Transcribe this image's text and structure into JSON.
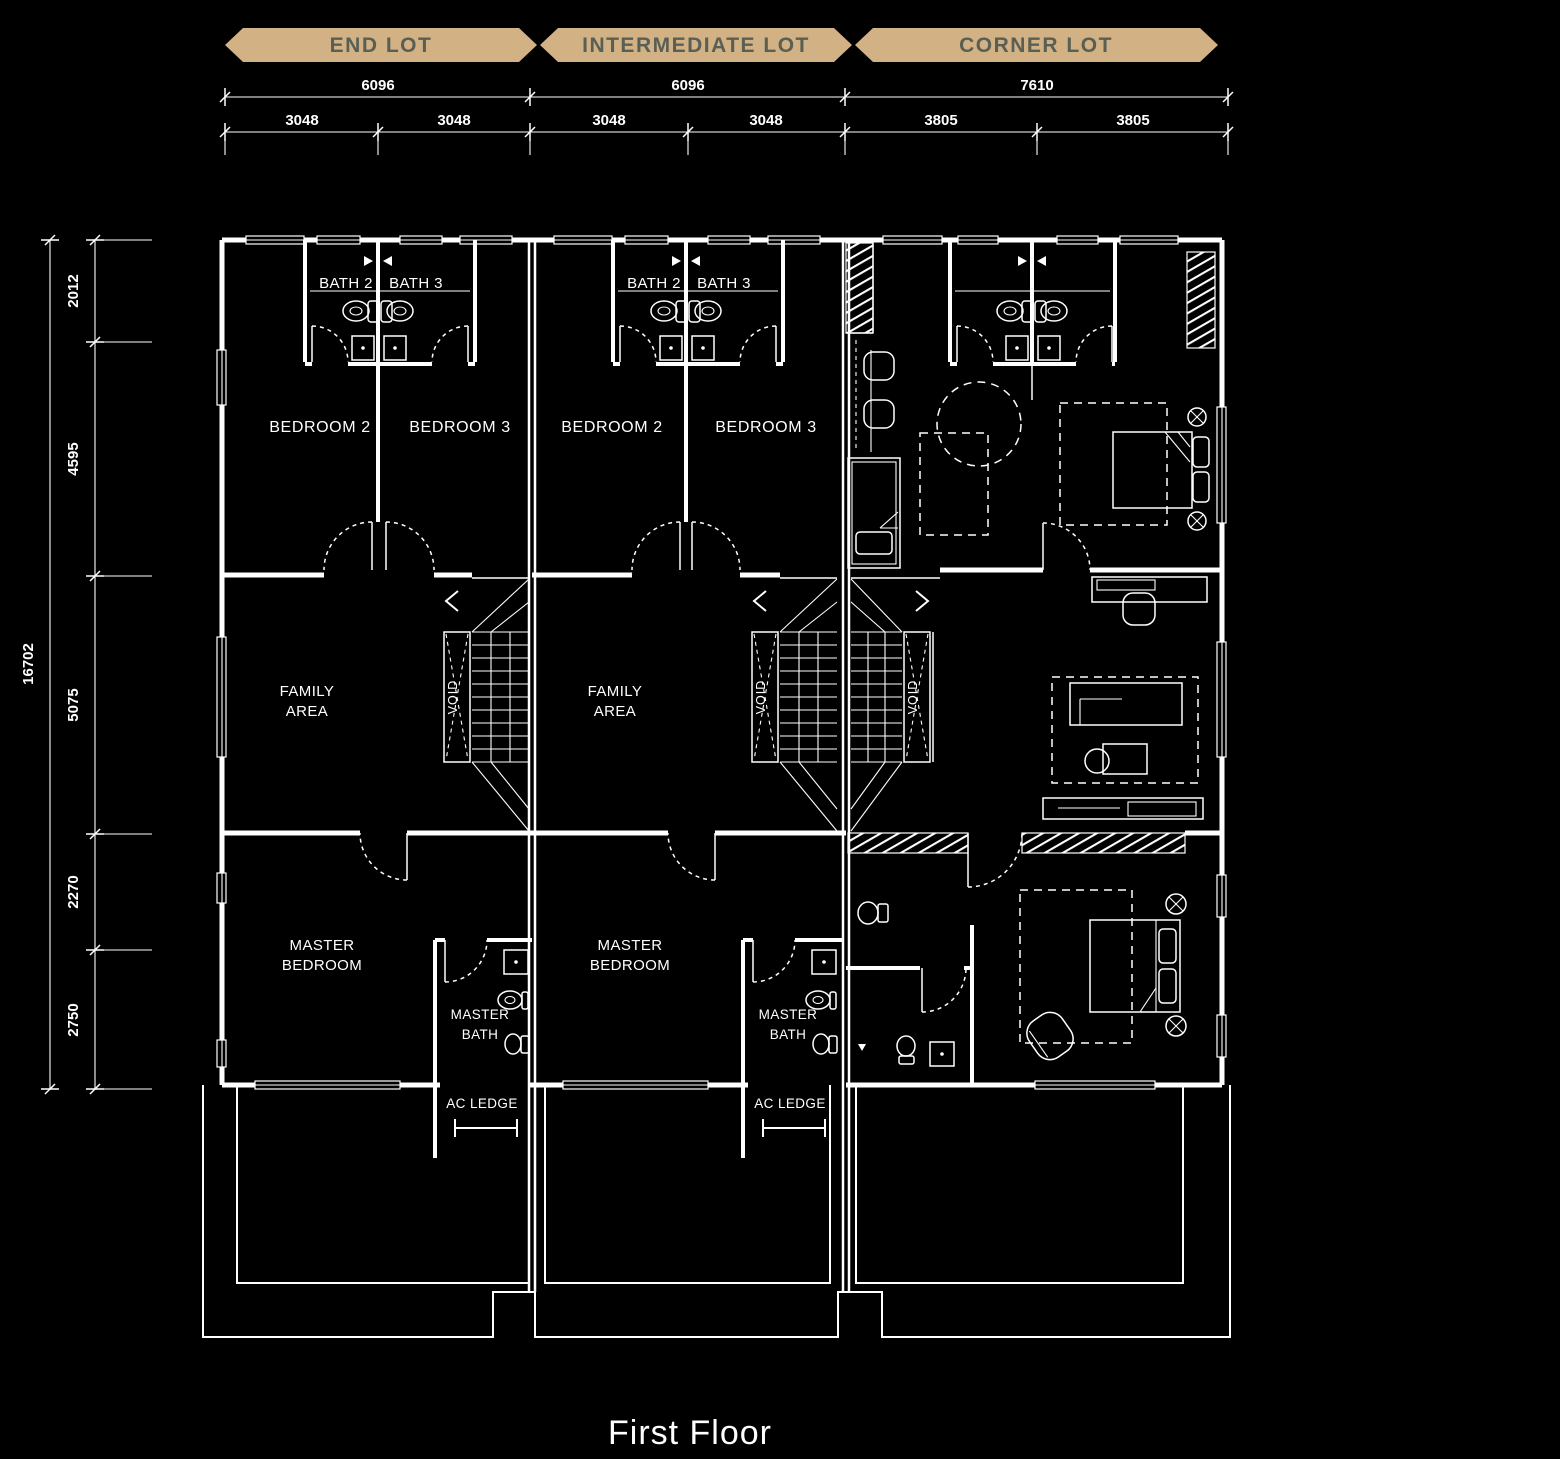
{
  "banners": [
    {
      "label": "END LOT"
    },
    {
      "label": "INTERMEDIATE LOT"
    },
    {
      "label": "CORNER LOT"
    }
  ],
  "dimensions": {
    "top": [
      {
        "total": "6096",
        "a": "3048",
        "b": "3048"
      },
      {
        "total": "6096",
        "a": "3048",
        "b": "3048"
      },
      {
        "total": "7610",
        "a": "3805",
        "b": "3805"
      }
    ],
    "left": {
      "total": "16702",
      "segments": [
        "2012",
        "4595",
        "5075",
        "2270",
        "2750"
      ]
    }
  },
  "labels": {
    "bath2": "BATH 2",
    "bath3": "BATH 3",
    "bedroom2": "BEDROOM 2",
    "bedroom3": "BEDROOM 3",
    "family_area": [
      "FAMILY",
      "AREA"
    ],
    "void": "VOID",
    "master_bedroom": [
      "MASTER",
      "BEDROOM"
    ],
    "master_bath": [
      "MASTER",
      "BATH"
    ],
    "ac_ledge": "AC LEDGE"
  },
  "caption": "First Floor",
  "colors": {
    "background": "#000000",
    "line": "#ffffff",
    "banner_fill": "#d2b185",
    "banner_text": "#5a5f54"
  }
}
